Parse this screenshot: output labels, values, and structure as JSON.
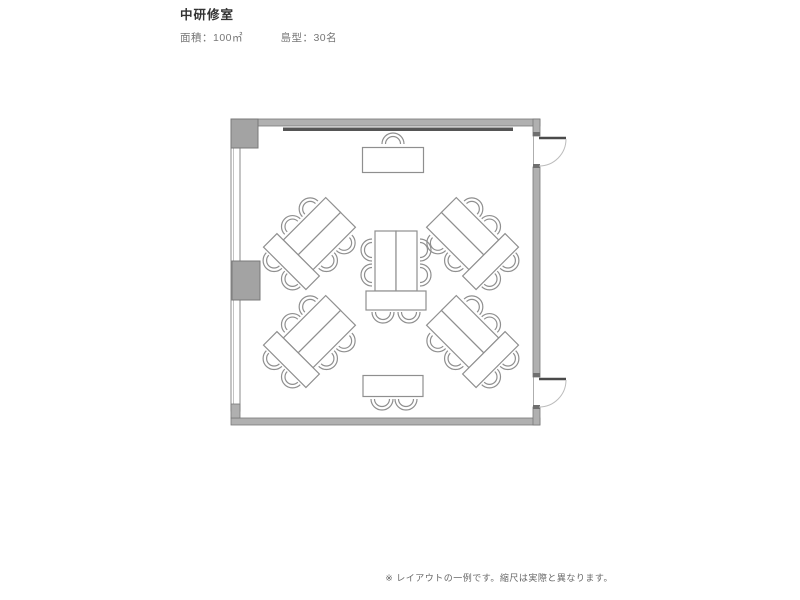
{
  "header": {
    "title": "中研修室",
    "specs": [
      {
        "label": "面積",
        "value": "100㎡",
        "text": "面積：100㎡"
      },
      {
        "label": "島型",
        "value": "30名",
        "text": "島型：30名"
      }
    ]
  },
  "footer": {
    "note": "※ レイアウトの一例です。縮尺は実際と異なります。"
  },
  "floorplan": {
    "room": {
      "label": "中研修室",
      "area": "100㎡",
      "layout_type": "島型",
      "capacity": "30名"
    },
    "colors": {
      "floor": "#ffffff",
      "wall": "#b0b0b0",
      "wall_edge": "#787878",
      "door_frame": "#6f6f6f",
      "column": "#a3a3a3",
      "furniture_line": "#8f8f8f",
      "whiteboard": "#555555",
      "door_leaf": "#4a4a4a",
      "door_arc": "#bcbcbc"
    },
    "furniture": {
      "islands": [
        {
          "id": "island-center",
          "cx": 396,
          "cy": 270,
          "rotation": 0,
          "seats": 6
        },
        {
          "id": "island-top-left",
          "cx": 313,
          "cy": 240,
          "rotation": 45,
          "seats": 6
        },
        {
          "id": "island-top-right",
          "cx": 469,
          "cy": 240,
          "rotation": -45,
          "seats": 6
        },
        {
          "id": "island-bottom-left",
          "cx": 313,
          "cy": 338,
          "rotation": 45,
          "seats": 6
        },
        {
          "id": "island-bottom-right",
          "cx": 469,
          "cy": 338,
          "rotation": -45,
          "seats": 6
        }
      ],
      "tables": [
        {
          "id": "presenter-table",
          "cx": 393,
          "cy": 160,
          "w": 61,
          "h": 25,
          "chairs": [
            {
              "dx": 0,
              "dy": -19,
              "angle": 180
            }
          ]
        },
        {
          "id": "rear-table",
          "cx": 393,
          "cy": 386,
          "w": 60,
          "h": 21,
          "chairs": [
            {
              "dx": -11,
              "dy": 16,
              "angle": 0
            },
            {
              "dx": 13,
              "dy": 16,
              "angle": 0
            }
          ]
        }
      ]
    },
    "features": {
      "doors": [
        {
          "id": "door-top",
          "wall": "right",
          "swing": "outward"
        },
        {
          "id": "door-bottom",
          "wall": "right",
          "swing": "outward"
        }
      ],
      "windows": [
        {
          "id": "window-left",
          "wall": "left"
        }
      ],
      "whiteboard": {
        "wall": "top"
      },
      "columns": 2
    }
  }
}
